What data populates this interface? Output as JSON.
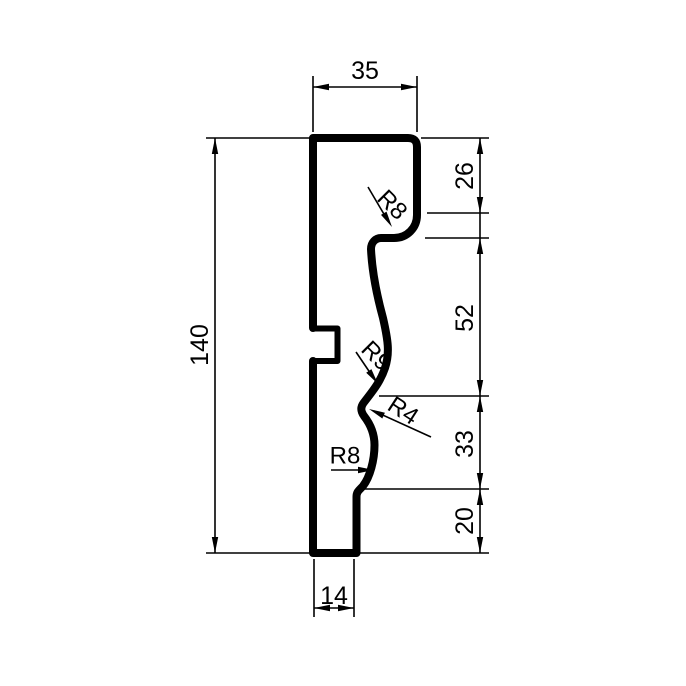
{
  "drawing": {
    "dimensions": {
      "top_width": "35",
      "total_height": "140",
      "upper_right": "26",
      "middle_right": "52",
      "lower_right": "33",
      "bottom_right": "20",
      "bottom_width": "14"
    },
    "radii": {
      "top_fillet": "R8",
      "ogee_upper": "R9",
      "ogee_lower": "R4",
      "base_fillet": "R8"
    },
    "colors": {
      "line": "#000000",
      "background": "#ffffff"
    }
  }
}
